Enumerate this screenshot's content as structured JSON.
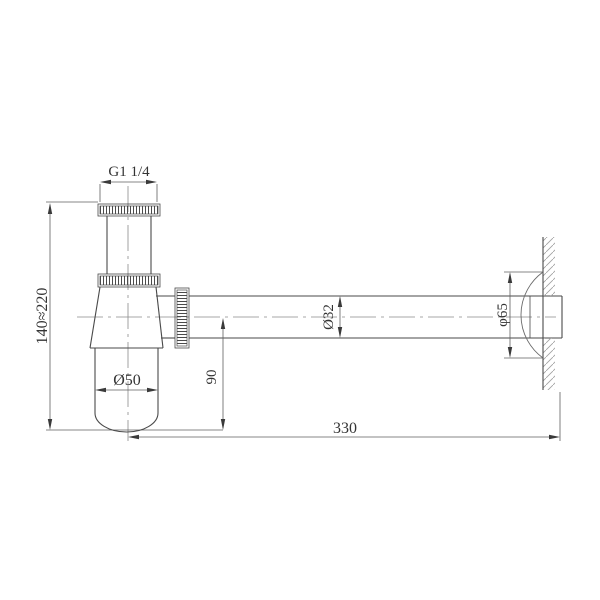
{
  "drawing": {
    "labels": {
      "thread_size": "G1  1/4",
      "height_range": "140≈220",
      "cup_diameter": "Ø50",
      "outlet_center_height": "90",
      "pipe_diameter": "Ø32",
      "flange_diameter": "φ65",
      "pipe_length": "330"
    },
    "colors": {
      "background": "#ffffff",
      "outline": "#4a4a4a",
      "dimension": "#5f5f5f",
      "hatch": "#a0a0a0",
      "text": "#333333"
    }
  }
}
